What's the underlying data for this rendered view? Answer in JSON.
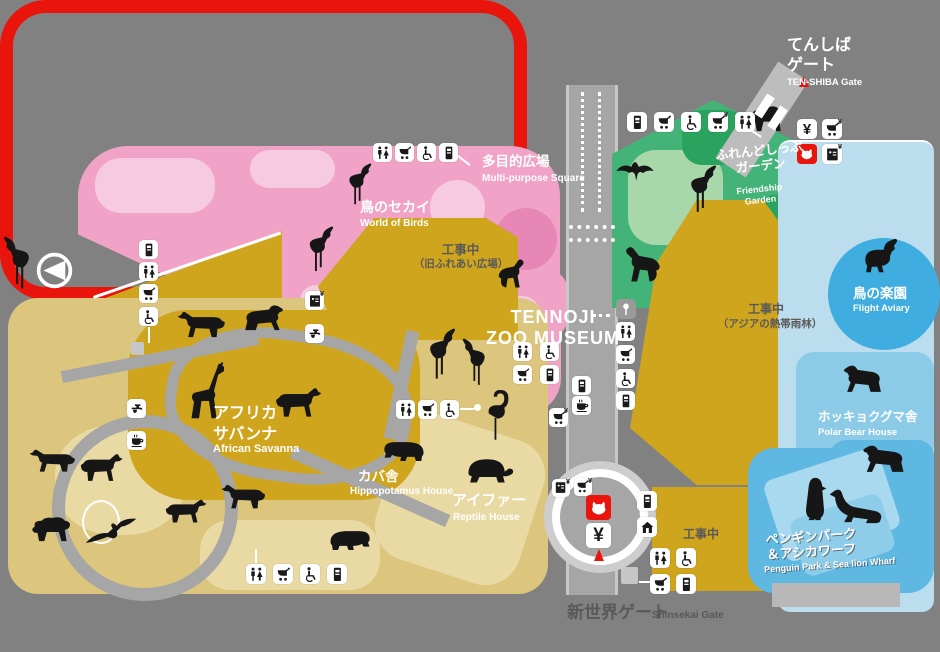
{
  "colors": {
    "bg": "#818181",
    "path": "#a6a6a6",
    "pathlight": "#c7c7c7",
    "pink": "#f0a3c6",
    "pinklight": "#f7cbdf",
    "pinkdark": "#e687b6",
    "gold": "#cfa51e",
    "tan": "#dcc57c",
    "tanlight": "#e9d9a3",
    "green": "#44b377",
    "greenlight": "#a8d8aa",
    "greendark": "#2aa35f",
    "bluebright": "#3fade0",
    "bluepale": "#bbdded",
    "bluemid": "#8ccbe8",
    "bluedeep": "#5fb8e2",
    "bluelighter": "#a9d9ef",
    "red": "#e9150d",
    "ink": "#161616",
    "textdark": "#595959",
    "white": "#ffffff"
  },
  "glyphs": {
    "yen": "¥"
  },
  "gates": {
    "tenshiba": {
      "jp": "てんしば\nゲート",
      "en": "TEN-SHIBA Gate"
    },
    "shinsekai": {
      "jp": "新世界ゲート",
      "en": "Shinsekai Gate"
    }
  },
  "areas": {
    "multi_purpose": {
      "jp": "多目的広場",
      "en": "Multi-purpose Square"
    },
    "world_of_birds": {
      "jp": "鳥のセカイ",
      "en": "World of Birds"
    },
    "construction_fureai": {
      "jp": "工事中",
      "note": "（旧ふれあい広場）"
    },
    "museum": {
      "en": "TENNOJI\nZOO MUSEUM"
    },
    "friendship_garden": {
      "jp": "ふれんどしっぷ\nガーデン",
      "en": "Friendship\nGarden"
    },
    "african_savanna": {
      "jp": "アフリカ\nサバンナ",
      "en": "African Savanna"
    },
    "hippo_house": {
      "jp": "カバ舎",
      "en": "Hippopotamus House"
    },
    "reptile_house": {
      "jp": "アイファー",
      "en": "Reptile House"
    },
    "flight_aviary": {
      "jp": "鳥の楽園",
      "en": "Flight Aviary"
    },
    "construction_asia": {
      "jp": "工事中",
      "note": "（アジアの熱帯雨林）"
    },
    "polar_bear": {
      "jp": "ホッキョクグマ舎",
      "en": "Polar Bear House"
    },
    "penguin_park": {
      "jp": "ペンギンパーク\n＆アシカワーフ",
      "en": "Penguin Park & Sea lion Wharf"
    },
    "construction_south": {
      "jp": "工事中"
    }
  },
  "markers": [
    {
      "t": "compass",
      "x": 36,
      "y": 252,
      "s": 37
    },
    {
      "t": "vending",
      "x": 139,
      "y": 240,
      "s": 19
    },
    {
      "t": "restroom",
      "x": 139,
      "y": 262,
      "s": 19
    },
    {
      "t": "stroller",
      "x": 139,
      "y": 284,
      "s": 19
    },
    {
      "t": "wheelchair",
      "x": 139,
      "y": 307,
      "s": 19
    },
    {
      "t": "booth",
      "x": 131,
      "y": 342,
      "s": 13
    },
    {
      "t": "faucet",
      "x": 127,
      "y": 399,
      "s": 19
    },
    {
      "t": "cafe",
      "x": 127,
      "y": 431,
      "s": 19
    },
    {
      "t": "locker",
      "x": 305,
      "y": 291,
      "s": 19
    },
    {
      "t": "faucet",
      "x": 305,
      "y": 324,
      "s": 19
    },
    {
      "t": "restroom",
      "x": 373,
      "y": 143,
      "s": 19
    },
    {
      "t": "stroller",
      "x": 395,
      "y": 143,
      "s": 19
    },
    {
      "t": "wheelchair",
      "x": 417,
      "y": 143,
      "s": 19
    },
    {
      "t": "vending",
      "x": 439,
      "y": 143,
      "s": 19
    },
    {
      "t": "restroom",
      "x": 396,
      "y": 400,
      "s": 19
    },
    {
      "t": "stroller",
      "x": 418,
      "y": 400,
      "s": 19
    },
    {
      "t": "wheelchair",
      "x": 440,
      "y": 400,
      "s": 19
    },
    {
      "t": "restroom",
      "x": 246,
      "y": 564,
      "s": 20
    },
    {
      "t": "stroller",
      "x": 273,
      "y": 564,
      "s": 20
    },
    {
      "t": "wheelchair",
      "x": 300,
      "y": 564,
      "s": 20
    },
    {
      "t": "vending",
      "x": 327,
      "y": 564,
      "s": 20
    },
    {
      "t": "restroom",
      "x": 513,
      "y": 342,
      "s": 19
    },
    {
      "t": "wheelchair",
      "x": 540,
      "y": 342,
      "s": 19
    },
    {
      "t": "stroller",
      "x": 513,
      "y": 365,
      "s": 19
    },
    {
      "t": "vending",
      "x": 540,
      "y": 365,
      "s": 19
    },
    {
      "t": "stroller_fee",
      "x": 549,
      "y": 408,
      "s": 19
    },
    {
      "t": "vending",
      "x": 572,
      "y": 376,
      "s": 19
    },
    {
      "t": "cafe",
      "x": 572,
      "y": 396,
      "s": 19
    },
    {
      "t": "signboard",
      "x": 616,
      "y": 299,
      "s": 20
    },
    {
      "t": "restroom",
      "x": 616,
      "y": 322,
      "s": 19
    },
    {
      "t": "stroller",
      "x": 616,
      "y": 345,
      "s": 19
    },
    {
      "t": "wheelchair",
      "x": 616,
      "y": 369,
      "s": 19
    },
    {
      "t": "vending",
      "x": 616,
      "y": 391,
      "s": 19
    },
    {
      "t": "vending",
      "x": 627,
      "y": 112,
      "s": 20
    },
    {
      "t": "stroller",
      "x": 654,
      "y": 112,
      "s": 20
    },
    {
      "t": "wheelchair",
      "x": 681,
      "y": 112,
      "s": 20
    },
    {
      "t": "stroller_fee",
      "x": 708,
      "y": 112,
      "s": 20
    },
    {
      "t": "restroom",
      "x": 735,
      "y": 112,
      "s": 20
    },
    {
      "t": "ticket",
      "x": 797,
      "y": 119,
      "s": 20
    },
    {
      "t": "stroller_fee",
      "x": 822,
      "y": 119,
      "s": 20
    },
    {
      "t": "logo",
      "x": 797,
      "y": 144,
      "s": 20
    },
    {
      "t": "locker",
      "x": 822,
      "y": 144,
      "s": 20
    },
    {
      "t": "locker",
      "x": 552,
      "y": 479,
      "s": 18
    },
    {
      "t": "stroller_fee",
      "x": 574,
      "y": 478,
      "s": 18
    },
    {
      "t": "logo",
      "x": 586,
      "y": 495,
      "s": 25
    },
    {
      "t": "ticket",
      "x": 586,
      "y": 523,
      "s": 25
    },
    {
      "t": "vending",
      "x": 637,
      "y": 491,
      "s": 20
    },
    {
      "t": "shop",
      "x": 637,
      "y": 517,
      "s": 20
    },
    {
      "t": "restroom",
      "x": 650,
      "y": 548,
      "s": 20
    },
    {
      "t": "wheelchair",
      "x": 676,
      "y": 548,
      "s": 20
    },
    {
      "t": "stroller",
      "x": 650,
      "y": 574,
      "s": 20
    },
    {
      "t": "vending",
      "x": 676,
      "y": 574,
      "s": 20
    },
    {
      "t": "booth",
      "x": 621,
      "y": 567,
      "s": 17
    }
  ],
  "animals": [
    {
      "t": "bird",
      "x": 343,
      "y": 163,
      "w": 30,
      "h": 44
    },
    {
      "t": "bird",
      "x": 303,
      "y": 226,
      "w": 32,
      "h": 48
    },
    {
      "t": "bird",
      "x": 2,
      "y": 236,
      "w": 34,
      "h": 56,
      "f": 1
    },
    {
      "t": "monkey",
      "x": 497,
      "y": 256,
      "w": 34,
      "h": 36
    },
    {
      "t": "bat",
      "x": 615,
      "y": 160,
      "w": 40,
      "h": 22
    },
    {
      "t": "bird",
      "x": 684,
      "y": 165,
      "w": 34,
      "h": 50
    },
    {
      "t": "sheep",
      "x": 747,
      "y": 102,
      "w": 42,
      "h": 32
    },
    {
      "t": "monkey",
      "x": 616,
      "y": 243,
      "w": 46,
      "h": 44,
      "f": 1
    },
    {
      "t": "duck",
      "x": 858,
      "y": 238,
      "w": 44,
      "h": 36
    },
    {
      "t": "bear",
      "x": 841,
      "y": 363,
      "w": 44,
      "h": 33,
      "f": 1
    },
    {
      "t": "bear",
      "x": 860,
      "y": 443,
      "w": 48,
      "h": 33,
      "f": 1
    },
    {
      "t": "penguin",
      "x": 802,
      "y": 476,
      "w": 26,
      "h": 46
    },
    {
      "t": "seal",
      "x": 826,
      "y": 480,
      "w": 58,
      "h": 46,
      "f": 1
    },
    {
      "t": "quad",
      "x": 176,
      "y": 310,
      "w": 52,
      "h": 31,
      "f": 1
    },
    {
      "t": "bear",
      "x": 241,
      "y": 303,
      "w": 45,
      "h": 31
    },
    {
      "t": "giraffe",
      "x": 184,
      "y": 362,
      "w": 40,
      "h": 58
    },
    {
      "t": "quad",
      "x": 273,
      "y": 386,
      "w": 50,
      "h": 35
    },
    {
      "t": "bird",
      "x": 423,
      "y": 328,
      "w": 34,
      "h": 54
    },
    {
      "t": "bird",
      "x": 461,
      "y": 338,
      "w": 30,
      "h": 50,
      "f": 1
    },
    {
      "t": "flamingo",
      "x": 484,
      "y": 390,
      "w": 26,
      "h": 54
    },
    {
      "t": "hippo",
      "x": 380,
      "y": 436,
      "w": 48,
      "h": 27,
      "f": 1
    },
    {
      "t": "hippo",
      "x": 326,
      "y": 525,
      "w": 48,
      "h": 27
    },
    {
      "t": "turtle",
      "x": 460,
      "y": 453,
      "w": 54,
      "h": 31
    },
    {
      "t": "quad",
      "x": 220,
      "y": 483,
      "w": 48,
      "h": 29,
      "f": 1
    },
    {
      "t": "quad",
      "x": 163,
      "y": 498,
      "w": 45,
      "h": 28
    },
    {
      "t": "quad",
      "x": 28,
      "y": 448,
      "w": 50,
      "h": 27,
      "f": 1
    },
    {
      "t": "quad",
      "x": 78,
      "y": 452,
      "w": 46,
      "h": 33
    },
    {
      "t": "sheep",
      "x": 28,
      "y": 513,
      "w": 48,
      "h": 31
    },
    {
      "t": "eagle",
      "x": 84,
      "y": 516,
      "w": 54,
      "h": 36
    }
  ],
  "highlight": {
    "color": "#e9150d"
  }
}
